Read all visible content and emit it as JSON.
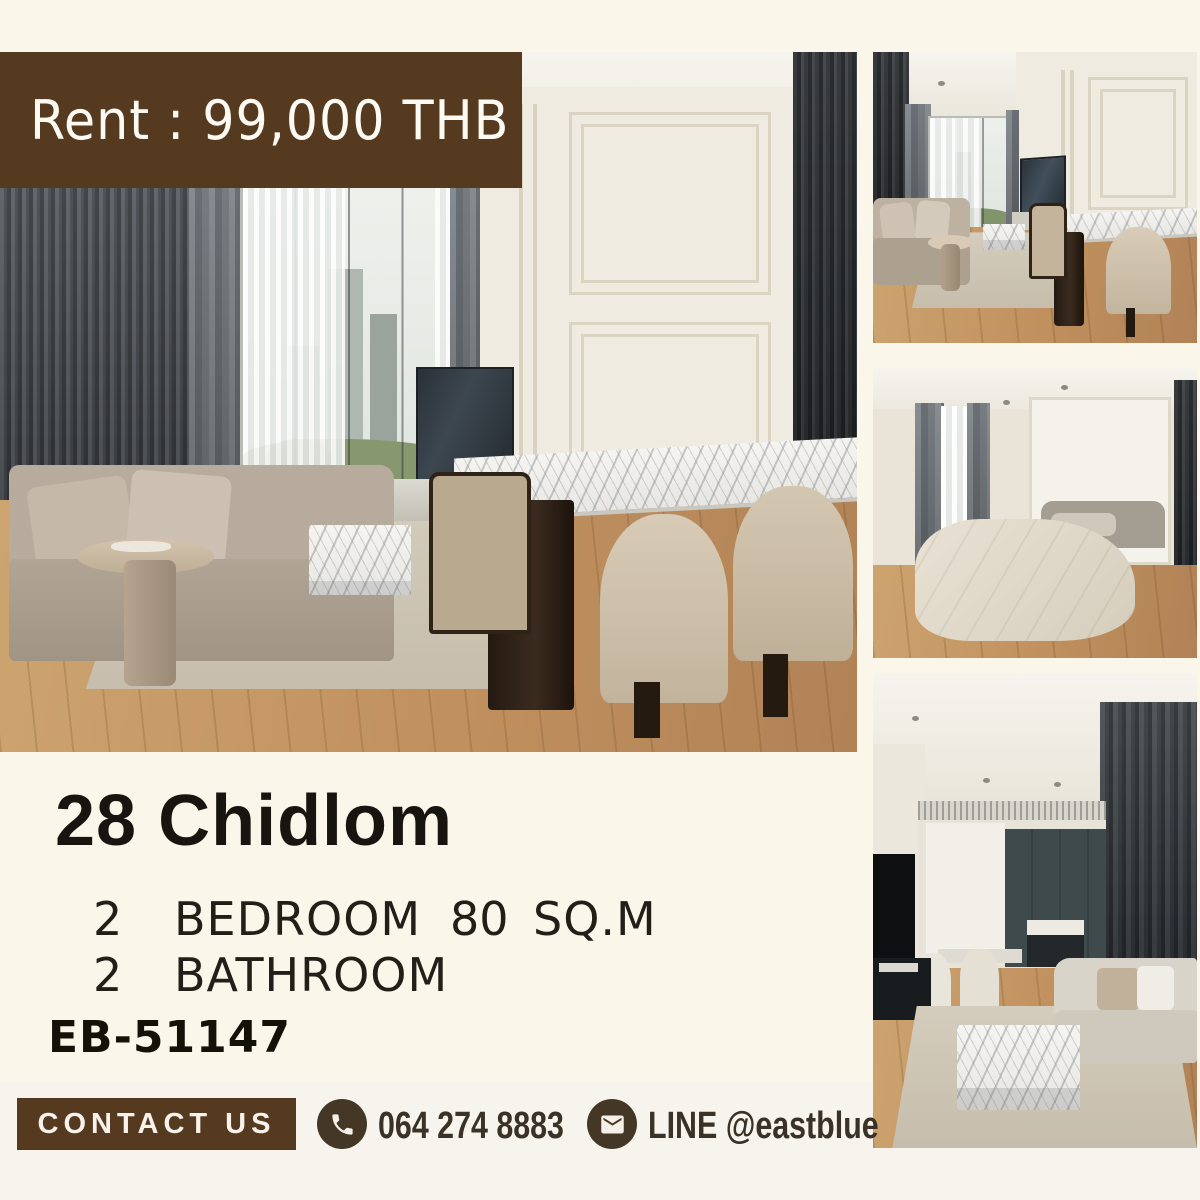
{
  "poster": {
    "banner": {
      "label": "Rent : 99,000 THB"
    },
    "listing": {
      "title": "28 Chidlom",
      "bedrooms_count": "2",
      "bedrooms_label": "BEDROOM",
      "area_value": "80",
      "area_label": "SQ.M",
      "bathrooms_count": "2",
      "bathrooms_label": "BATHROOM",
      "reference_code": "EB-51147"
    },
    "contact": {
      "button_label": "CONTACT US",
      "phone_icon": "phone-icon",
      "phone_number": "064 274 8883",
      "line_icon": "envelope-icon",
      "line_account": "LINE @eastblue"
    },
    "colors": {
      "banner_brown": "#563a20",
      "background_cream": "#fbf6ea",
      "footer_band": "#f7f4ee",
      "text_dark": "#1f1c17",
      "contact_text_brown": "#3a3227",
      "badge_brown": "#453726"
    }
  }
}
